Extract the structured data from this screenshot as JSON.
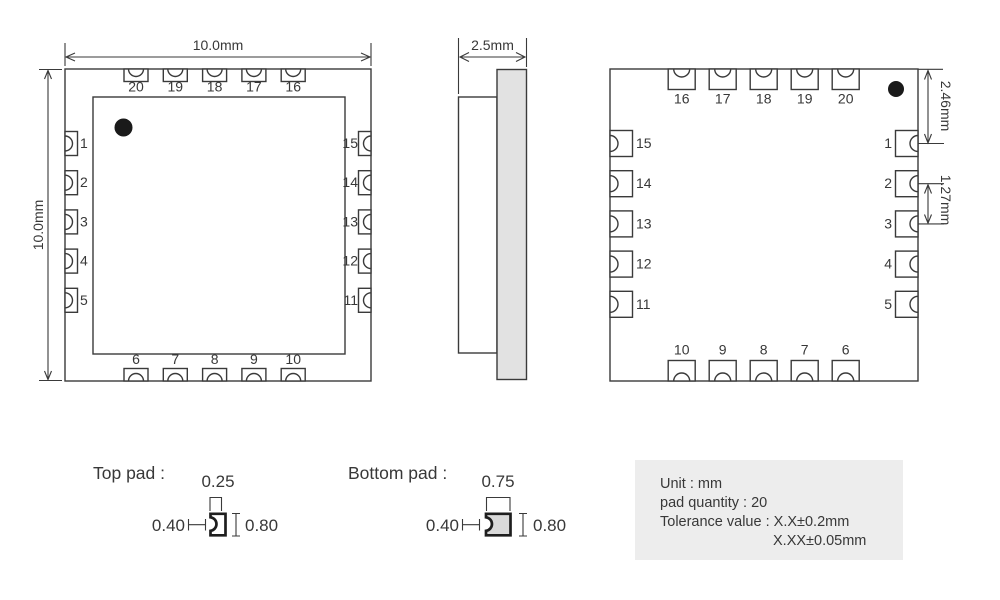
{
  "top_view": {
    "dim_width": "10.0mm",
    "dim_height": "10.0mm",
    "pins_top": [
      "20",
      "19",
      "18",
      "17",
      "16"
    ],
    "pins_left": [
      "1",
      "2",
      "3",
      "4",
      "5"
    ],
    "pins_right": [
      "15",
      "14",
      "13",
      "12",
      "11"
    ],
    "pins_bottom": [
      "6",
      "7",
      "8",
      "9",
      "10"
    ]
  },
  "side_view": {
    "dim_width": "2.5mm"
  },
  "bottom_view": {
    "pins_top": [
      "16",
      "17",
      "18",
      "19",
      "20"
    ],
    "pins_left": [
      "15",
      "14",
      "13",
      "12",
      "11"
    ],
    "pins_right": [
      "1",
      "2",
      "3",
      "4",
      "5"
    ],
    "pins_bottom": [
      "10",
      "9",
      "8",
      "7",
      "6"
    ],
    "dim_edge_to_pin1": "2.46mm",
    "dim_pitch": "1.27mm"
  },
  "pad_details": {
    "top_pad": {
      "title": "Top pad :",
      "notch_width": "0.25",
      "pad_width": "0.40",
      "pad_length": "0.80"
    },
    "bottom_pad": {
      "title": "Bottom pad :",
      "notch_width": "0.75",
      "pad_width": "0.40",
      "pad_length": "0.80"
    }
  },
  "info_box": {
    "line1": "Unit : mm",
    "line2": "pad quantity : 20",
    "line3": "Tolerance value : X.X±0.2mm",
    "line4": "X.XX±0.05mm"
  },
  "colors": {
    "line": "#3a3a3a",
    "dot": "#1a1a1a",
    "module_fill": "#e2e2e2",
    "detail_pad_fill": "#d9d9d9",
    "info_box_bg": "#ededed"
  }
}
